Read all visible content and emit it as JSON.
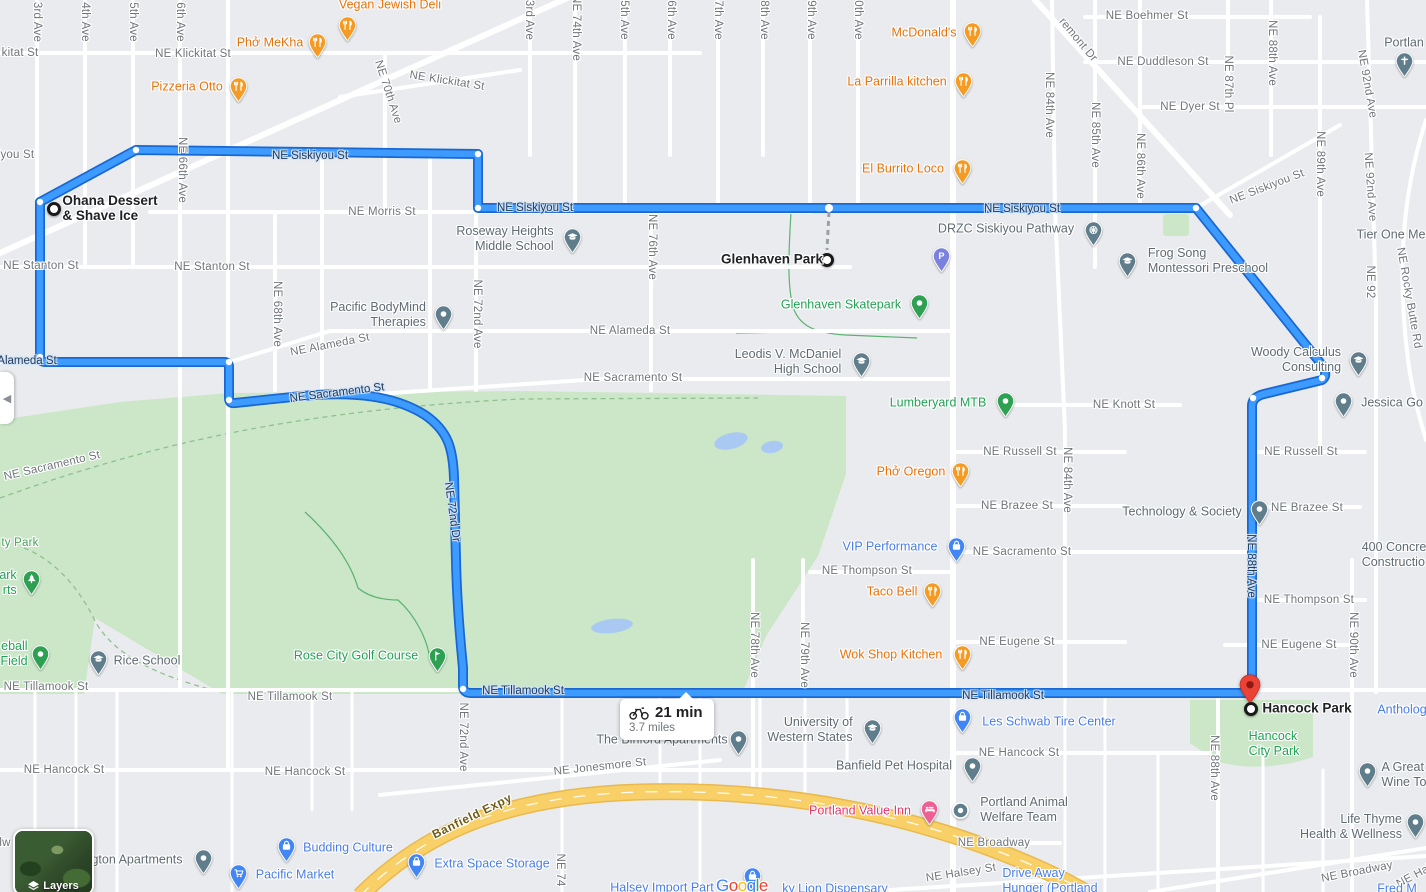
{
  "route": {
    "duration": "21 min",
    "distance": "3.7 miles",
    "mode": "bicycling",
    "start_label_lines": [
      "Ohana Dessert",
      "& Shave Ice"
    ],
    "waypoint_label": "Glenhaven Park",
    "end_label": "Hancock Park"
  },
  "controls": {
    "layers": "Layers",
    "collapse_glyph": "◀"
  },
  "brand": {
    "logo": "Google",
    "letter_colors": [
      "#4285F4",
      "#EA4335",
      "#FBBC05",
      "#4285F4",
      "#34A853",
      "#EA4335"
    ]
  },
  "colors": {
    "route_fill": "#3d9bff",
    "route_casing": "#1967d2",
    "land": "#e9ebee",
    "park_green": "#cbe7c8",
    "water": "#a9c9f2",
    "expressway": "#f8d067",
    "poi_orange": "#e8710a",
    "poi_blue": "#4a7de8",
    "poi_gray": "#5f6a72",
    "poi_green": "#23a155",
    "poi_pink": "#e8336e",
    "poi_purple": "#7b82dd"
  },
  "street_labels": [
    {
      "t": "3rd Ave",
      "x": 37,
      "y": 22,
      "r": 90
    },
    {
      "t": "4th Ave",
      "x": 85,
      "y": 22,
      "r": 90
    },
    {
      "t": "5th Ave",
      "x": 133,
      "y": 22,
      "r": 90
    },
    {
      "t": "6th Ave",
      "x": 180,
      "y": 22,
      "r": 90
    },
    {
      "t": "kitat St",
      "x": 20,
      "y": 53
    },
    {
      "t": "NE Klickitat St",
      "x": 193,
      "y": 54
    },
    {
      "t": "NE 66th Ave",
      "x": 182,
      "y": 170,
      "r": 90
    },
    {
      "t": "NE 70th Ave",
      "x": 388,
      "y": 92,
      "r": 72
    },
    {
      "t": "NE Klickitat St",
      "x": 447,
      "y": 81,
      "r": 9
    },
    {
      "t": "iyou St",
      "x": 16,
      "y": 155
    },
    {
      "t": "NE Morris St",
      "x": 382,
      "y": 212
    },
    {
      "t": "NE Stanton St",
      "x": 41,
      "y": 266
    },
    {
      "t": "NE Stanton St",
      "x": 212,
      "y": 267
    },
    {
      "t": "NE 68th Ave",
      "x": 277,
      "y": 314,
      "r": 90
    },
    {
      "t": "NE 72nd Ave",
      "x": 477,
      "y": 314,
      "r": 90
    },
    {
      "t": "NE Alameda St",
      "x": 330,
      "y": 345,
      "r": -11
    },
    {
      "t": "NE Alameda St",
      "x": 630,
      "y": 331
    },
    {
      "t": "NE Sacramento St",
      "x": 633,
      "y": 378
    },
    {
      "t": "NE Sacramento St",
      "x": 52,
      "y": 466,
      "r": -13
    },
    {
      "t": "NE 76th Ave",
      "x": 652,
      "y": 247,
      "r": 90
    },
    {
      "t": "3rd Ave",
      "x": 529,
      "y": 20,
      "r": 90
    },
    {
      "t": "NE 74th Ave",
      "x": 576,
      "y": 28,
      "r": 90
    },
    {
      "t": "5th Ave",
      "x": 624,
      "y": 20,
      "r": 90
    },
    {
      "t": "6th Ave",
      "x": 671,
      "y": 20,
      "r": 90
    },
    {
      "t": "7th Ave",
      "x": 718,
      "y": 20,
      "r": 90
    },
    {
      "t": "8th Ave",
      "x": 764,
      "y": 20,
      "r": 90
    },
    {
      "t": "9th Ave",
      "x": 811,
      "y": 20,
      "r": 90
    },
    {
      "t": "0th Ave",
      "x": 858,
      "y": 20,
      "r": 90
    },
    {
      "t": "remont Dr",
      "x": 1078,
      "y": 40,
      "r": 50
    },
    {
      "t": "NE Boehmer St",
      "x": 1147,
      "y": 16
    },
    {
      "t": "NE Duddleson St",
      "x": 1163,
      "y": 62
    },
    {
      "t": "NE Dyer St",
      "x": 1190,
      "y": 107
    },
    {
      "t": "NE 84th Ave",
      "x": 1049,
      "y": 105,
      "r": 90
    },
    {
      "t": "NE 85th Ave",
      "x": 1095,
      "y": 135,
      "r": 90
    },
    {
      "t": "NE 86th Ave",
      "x": 1140,
      "y": 166,
      "r": 90
    },
    {
      "t": "NE 87th Pl",
      "x": 1228,
      "y": 84,
      "r": 90
    },
    {
      "t": "NE 88th Ave",
      "x": 1272,
      "y": 53,
      "r": 90
    },
    {
      "t": "NE 89th Ave",
      "x": 1320,
      "y": 164,
      "r": 90
    },
    {
      "t": "NE 92nd Ave",
      "x": 1367,
      "y": 84,
      "r": 80
    },
    {
      "t": "NE 92nd Ave",
      "x": 1370,
      "y": 187,
      "r": 86
    },
    {
      "t": "NE 92",
      "x": 1370,
      "y": 282,
      "r": 90
    },
    {
      "t": "NE Siskiyou St",
      "x": 1267,
      "y": 187,
      "r": -21
    },
    {
      "t": "NE Rocky Butte Rd",
      "x": 1409,
      "y": 298,
      "r": 80
    },
    {
      "t": "NE Knott St",
      "x": 1124,
      "y": 405
    },
    {
      "t": "NE Russell St",
      "x": 1020,
      "y": 452
    },
    {
      "t": "NE Russell St",
      "x": 1301,
      "y": 452
    },
    {
      "t": "NE Brazee St",
      "x": 1017,
      "y": 506
    },
    {
      "t": "NE Brazee St",
      "x": 1307,
      "y": 508
    },
    {
      "t": "NE Sacramento St",
      "x": 1022,
      "y": 552
    },
    {
      "t": "NE Thompson St",
      "x": 867,
      "y": 571
    },
    {
      "t": "NE Thompson St",
      "x": 1309,
      "y": 600
    },
    {
      "t": "NE Eugene St",
      "x": 1017,
      "y": 642
    },
    {
      "t": "NE Eugene St",
      "x": 1299,
      "y": 645
    },
    {
      "t": "NE 84th Ave",
      "x": 1067,
      "y": 480,
      "r": 90
    },
    {
      "t": "NE 90th Ave",
      "x": 1353,
      "y": 645,
      "r": 90
    },
    {
      "t": "NE 78th Ave",
      "x": 754,
      "y": 645,
      "r": 90
    },
    {
      "t": "NE 79th Ave",
      "x": 804,
      "y": 655,
      "r": 90
    },
    {
      "t": "ty Park",
      "x": 20,
      "y": 543,
      "c": "park"
    },
    {
      "t": "NE Tillamook St",
      "x": 46,
      "y": 687
    },
    {
      "t": "NE Tillamook St",
      "x": 290,
      "y": 697
    },
    {
      "t": "NE 72nd Ave",
      "x": 463,
      "y": 737,
      "r": 90
    },
    {
      "t": "NE Hancock St",
      "x": 64,
      "y": 770
    },
    {
      "t": "NE Hancock St",
      "x": 305,
      "y": 772
    },
    {
      "t": "NE Hancock St",
      "x": 1019,
      "y": 753
    },
    {
      "t": "NE 88th Ave",
      "x": 1214,
      "y": 768,
      "r": 90
    },
    {
      "t": "NE Jonesmore St",
      "x": 600,
      "y": 767,
      "r": -6
    },
    {
      "t": "NE Broadway",
      "x": 994,
      "y": 843
    },
    {
      "t": "NE Broadway",
      "x": 1357,
      "y": 872,
      "r": -11
    },
    {
      "t": "NE Halsey St",
      "x": 961,
      "y": 873,
      "r": -9
    },
    {
      "t": "NE Hal",
      "x": 1414,
      "y": 876,
      "r": -28
    },
    {
      "t": "NE 74",
      "x": 560,
      "y": 870,
      "r": 90
    },
    {
      "t": "lw",
      "x": 5,
      "y": 843
    },
    {
      "t": "Banfield Expy",
      "x": 472,
      "y": 816,
      "r": -26,
      "c": "expwy"
    }
  ],
  "route_labels": [
    {
      "t": "NE Siskiyou St",
      "x": 310,
      "y": 156
    },
    {
      "t": "NE Siskiyou St",
      "x": 535,
      "y": 208
    },
    {
      "t": "NE Siskiyou St",
      "x": 1022,
      "y": 209
    },
    {
      "t": "Alameda St",
      "x": 27,
      "y": 361
    },
    {
      "t": "NE Sacramento St",
      "x": 337,
      "y": 393,
      "r": -7
    },
    {
      "t": "NE 72nd Dr",
      "x": 452,
      "y": 512,
      "r": 82
    },
    {
      "t": "NE Tillamook St",
      "x": 523,
      "y": 691
    },
    {
      "t": "NE Tillamook St",
      "x": 1003,
      "y": 696
    },
    {
      "t": "NE 88th Ave",
      "x": 1251,
      "y": 566,
      "r": 90
    }
  ],
  "pois": [
    {
      "l": [
        "Vegan Jewish Deli"
      ],
      "c": "orange",
      "pin": "restaurant",
      "px": 347,
      "py": 26,
      "lx": 390,
      "ly": 5
    },
    {
      "l": [
        "Phở MeKha"
      ],
      "c": "orange",
      "pin": "restaurant",
      "px": 317,
      "py": 43,
      "lx": 270,
      "ly": 43
    },
    {
      "l": [
        "Pizzeria Otto"
      ],
      "c": "orange",
      "pin": "restaurant",
      "px": 238,
      "py": 87,
      "lx": 187,
      "ly": 87
    },
    {
      "l": [
        "McDonald's"
      ],
      "c": "orange",
      "pin": "restaurant",
      "px": 972,
      "py": 32,
      "lx": 924,
      "ly": 33
    },
    {
      "l": [
        "La Parrilla kitchen"
      ],
      "c": "orange",
      "pin": "restaurant",
      "px": 963,
      "py": 82,
      "lx": 897,
      "ly": 82
    },
    {
      "l": [
        "El Burrito Loco"
      ],
      "c": "orange",
      "pin": "restaurant",
      "px": 962,
      "py": 169,
      "lx": 903,
      "ly": 169
    },
    {
      "l": [
        "Phở Oregon"
      ],
      "c": "orange",
      "pin": "restaurant",
      "px": 960,
      "py": 472,
      "lx": 911,
      "ly": 472
    },
    {
      "l": [
        "Taco Bell"
      ],
      "c": "orange",
      "pin": "restaurant",
      "px": 932,
      "py": 592,
      "lx": 892,
      "ly": 592
    },
    {
      "l": [
        "Wok Shop Kitchen"
      ],
      "c": "orange",
      "pin": "restaurant",
      "px": 962,
      "py": 655,
      "lx": 891,
      "ly": 655
    },
    {
      "l": [
        "VIP Performance"
      ],
      "c": "blue",
      "pin": "bag",
      "px": 956,
      "py": 547,
      "lx": 890,
      "ly": 547
    },
    {
      "l": [
        "Les Schwab Tire Center"
      ],
      "c": "blue",
      "pin": "bag",
      "px": 962,
      "py": 718,
      "lx": 1049,
      "ly": 722,
      "al": "left"
    },
    {
      "l": [
        "Budding Culture"
      ],
      "c": "blue",
      "pin": "bag",
      "px": 286,
      "py": 847,
      "lx": 348,
      "ly": 848,
      "al": "left"
    },
    {
      "l": [
        "Extra Space Storage"
      ],
      "c": "blue",
      "pin": "bag",
      "px": 416,
      "py": 863,
      "lx": 492,
      "ly": 864,
      "al": "left"
    },
    {
      "l": [
        "Pacific Market"
      ],
      "c": "blue",
      "pin": "cart",
      "px": 238,
      "py": 874,
      "lx": 295,
      "ly": 875,
      "al": "left"
    },
    {
      "l": [
        "Halsey Import Part"
      ],
      "c": "blue",
      "pin": "none",
      "lx": 662,
      "ly": 888
    },
    {
      "l": [],
      "c": "blue",
      "pin": "bag",
      "px": 752,
      "py": 877,
      "lx": 752,
      "ly": 877
    },
    {
      "l": [
        "ky Lion Dispensary"
      ],
      "c": "blue",
      "pin": "none",
      "lx": 835,
      "ly": 889
    },
    {
      "l": [
        "Drive Away",
        "Hunger (Portland"
      ],
      "c": "blue",
      "pin": "none",
      "lx": 1050,
      "ly": 881,
      "al": "left"
    },
    {
      "l": [
        "Antholog"
      ],
      "c": "blue",
      "pin": "none",
      "lx": 1402,
      "ly": 710
    },
    {
      "l": [
        "Fred M"
      ],
      "c": "blue",
      "pin": "none",
      "lx": 1397,
      "ly": 889
    },
    {
      "l": [
        "Roseway Heights",
        "Middle School"
      ],
      "c": "gray",
      "pin": "school",
      "px": 572,
      "py": 238,
      "lx": 505,
      "ly": 239,
      "al": "right"
    },
    {
      "l": [
        "Pacific BodyMind",
        "Therapies"
      ],
      "c": "gray",
      "pin": "generic",
      "px": 443,
      "py": 315,
      "lx": 378,
      "ly": 315,
      "al": "right"
    },
    {
      "l": [
        "Leodis V. McDaniel",
        "High School"
      ],
      "c": "gray",
      "pin": "school",
      "px": 861,
      "py": 362,
      "lx": 788,
      "ly": 362,
      "al": "right"
    },
    {
      "l": [
        "Frog Song",
        "Montessori Preschool"
      ],
      "c": "gray",
      "pin": "school",
      "px": 1127,
      "py": 262,
      "lx": 1208,
      "ly": 261,
      "al": "left"
    },
    {
      "l": [
        "DRZC Siskiyou Pathway"
      ],
      "c": "gray",
      "pin": "dharma",
      "px": 1093,
      "py": 231,
      "lx": 1006,
      "ly": 229,
      "al": "right"
    },
    {
      "l": [
        "Woody Calculus",
        "Consulting"
      ],
      "c": "gray",
      "pin": "school",
      "px": 1358,
      "py": 361,
      "lx": 1296,
      "ly": 360,
      "al": "right"
    },
    {
      "l": [
        "Jessica Go"
      ],
      "c": "gray",
      "pin": "generic",
      "px": 1343,
      "py": 402,
      "lx": 1392,
      "ly": 403,
      "al": "left"
    },
    {
      "l": [
        "The Binford Apartments"
      ],
      "c": "gray",
      "pin": "generic",
      "px": 738,
      "py": 740,
      "lx": 662,
      "ly": 740,
      "al": "right"
    },
    {
      "l": [
        "University of",
        "Western States"
      ],
      "c": "gray",
      "pin": "school",
      "px": 872,
      "py": 729,
      "lx": 810,
      "ly": 730,
      "al": "right"
    },
    {
      "l": [
        "Banfield Pet Hospital"
      ],
      "c": "gray",
      "pin": "generic",
      "px": 972,
      "py": 767,
      "lx": 894,
      "ly": 766,
      "al": "right"
    },
    {
      "l": [
        "Portland Animal",
        "Welfare Team"
      ],
      "c": "gray",
      "pin": "circledot",
      "px": 960,
      "py": 810,
      "lx": 1024,
      "ly": 810,
      "al": "left"
    },
    {
      "l": [
        "Rice School"
      ],
      "c": "gray",
      "pin": "school",
      "px": 98,
      "py": 660,
      "lx": 147,
      "ly": 661,
      "al": "left"
    },
    {
      "l": [
        "gton Apartments"
      ],
      "c": "gray",
      "pin": "generic",
      "px": 203,
      "py": 859,
      "lx": 137,
      "ly": 860,
      "al": "right"
    },
    {
      "l": [
        "A Great",
        "Wine To"
      ],
      "c": "gray",
      "pin": "generic",
      "px": 1367,
      "py": 772,
      "lx": 1404,
      "ly": 775,
      "al": "left"
    },
    {
      "l": [
        "Life Thyme",
        "Health & Wellness"
      ],
      "c": "gray",
      "pin": "generic",
      "px": 1415,
      "py": 823,
      "lx": 1351,
      "ly": 827,
      "al": "right"
    },
    {
      "l": [
        "Portlan"
      ],
      "c": "gray",
      "pin": "church",
      "px": 1404,
      "py": 62,
      "lx": 1404,
      "ly": 43
    },
    {
      "l": [
        "Tier One Me"
      ],
      "c": "gray",
      "pin": "none",
      "lx": 1391,
      "ly": 235
    },
    {
      "l": [
        "400 Concre",
        "Constructio"
      ],
      "c": "gray",
      "pin": "none",
      "lx": 1394,
      "ly": 555,
      "al": "left"
    },
    {
      "l": [
        "Technology & Society"
      ],
      "c": "gray",
      "pin": "generic",
      "px": 1259,
      "py": 510,
      "lx": 1182,
      "ly": 512,
      "al": "right"
    },
    {
      "l": [
        "Glenhaven Skatepark"
      ],
      "c": "green",
      "pin": "generic",
      "px": 919,
      "py": 304,
      "lx": 841,
      "ly": 305,
      "al": "right"
    },
    {
      "l": [
        "Lumberyard MTB"
      ],
      "c": "green",
      "pin": "generic",
      "px": 1005,
      "py": 402,
      "lx": 938,
      "ly": 403,
      "al": "right"
    },
    {
      "l": [
        "Rose City Golf Course"
      ],
      "c": "green",
      "pin": "golf",
      "px": 437,
      "py": 657,
      "lx": 356,
      "ly": 656,
      "al": "right"
    },
    {
      "l": [
        "eball",
        "Field"
      ],
      "c": "green",
      "pin": "generic",
      "px": 40,
      "py": 655,
      "lx": 14,
      "ly": 654,
      "al": "right"
    },
    {
      "l": [
        "ark",
        "rts"
      ],
      "c": "green",
      "pin": "tree",
      "px": 31,
      "py": 580,
      "lx": 8,
      "ly": 583,
      "al": "right"
    },
    {
      "l": [
        "Hancock",
        "City Park"
      ],
      "c": "green",
      "pin": "none",
      "lx": 1274,
      "ly": 744,
      "al": "left"
    },
    {
      "l": [
        "Portland Value Inn"
      ],
      "c": "pink",
      "pin": "bed",
      "px": 929,
      "py": 810,
      "lx": 860,
      "ly": 811,
      "al": "right"
    },
    {
      "l": [],
      "c": "purple",
      "pin": "parking",
      "px": 941,
      "py": 257,
      "lx": 941,
      "ly": 257
    },
    {
      "l": [
        "Ohana Dessert",
        "& Shave Ice"
      ],
      "c": "black",
      "pin": "none",
      "lx": 110,
      "ly": 208,
      "al": "left",
      "bold": true
    },
    {
      "l": [
        "Glenhaven Park"
      ],
      "c": "black",
      "pin": "none",
      "lx": 772,
      "ly": 259,
      "al": "right",
      "bold": true
    },
    {
      "l": [
        "Hancock Park"
      ],
      "c": "black",
      "pin": "none",
      "lx": 1307,
      "ly": 708,
      "al": "left",
      "bold": true
    }
  ]
}
